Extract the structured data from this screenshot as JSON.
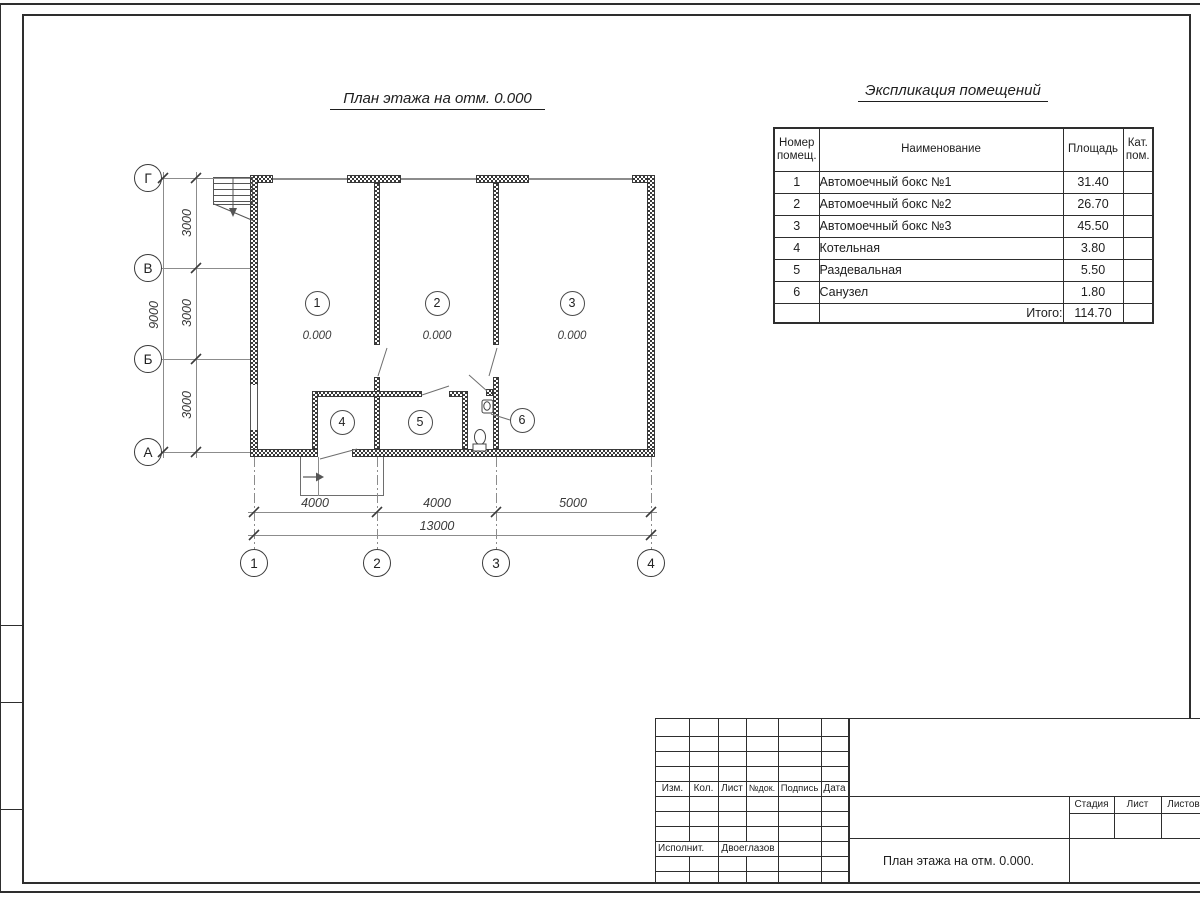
{
  "colors": {
    "line_dark": "#2e2e2e",
    "line_medium": "#3a3a3a",
    "line_thin": "#8c8c8c",
    "paper": "#ffffff"
  },
  "plan": {
    "title": "План этажа на отм. 0.000",
    "axes_rows": [
      "Г",
      "В",
      "Б",
      "А"
    ],
    "axes_cols": [
      "1",
      "2",
      "3",
      "4"
    ],
    "dims_left": [
      "3000",
      "3000",
      "3000"
    ],
    "dim_left_total": "9000",
    "dims_bottom": [
      "4000",
      "4000",
      "5000"
    ],
    "dim_bottom_total": "13000",
    "rooms": [
      {
        "num": "1",
        "elev": "0.000"
      },
      {
        "num": "2",
        "elev": "0.000"
      },
      {
        "num": "3",
        "elev": "0.000"
      },
      {
        "num": "4",
        "elev": ""
      },
      {
        "num": "5",
        "elev": ""
      },
      {
        "num": "6",
        "elev": ""
      }
    ]
  },
  "explication": {
    "title": "Экспликация помещений",
    "headers": {
      "num": "Номер помещ.",
      "name": "Наименование",
      "area": "Площадь",
      "cat": "Кат. пом."
    },
    "rows": [
      {
        "num": "1",
        "name": "Автомоечный бокс №1",
        "area": "31.40"
      },
      {
        "num": "2",
        "name": "Автомоечный бокс №2",
        "area": "26.70"
      },
      {
        "num": "3",
        "name": "Автомоечный бокс №3",
        "area": "45.50"
      },
      {
        "num": "4",
        "name": "Котельная",
        "area": "3.80"
      },
      {
        "num": "5",
        "name": "Раздевальная",
        "area": "5.50"
      },
      {
        "num": "6",
        "name": "Санузел",
        "area": "1.80"
      }
    ],
    "total_label": "Итого:",
    "total_value": "114.70"
  },
  "titleblock": {
    "cols": [
      "Изм.",
      "Кол.",
      "Лист",
      "№док.",
      "Подпись",
      "Дата"
    ],
    "executor_label": "Исполнит.",
    "executor_name": "Двоеглазов",
    "stage_label": "Стадия",
    "sheet_label": "Лист",
    "sheets_label": "Листов",
    "doc_title": "План этажа на отм. 0.000."
  }
}
